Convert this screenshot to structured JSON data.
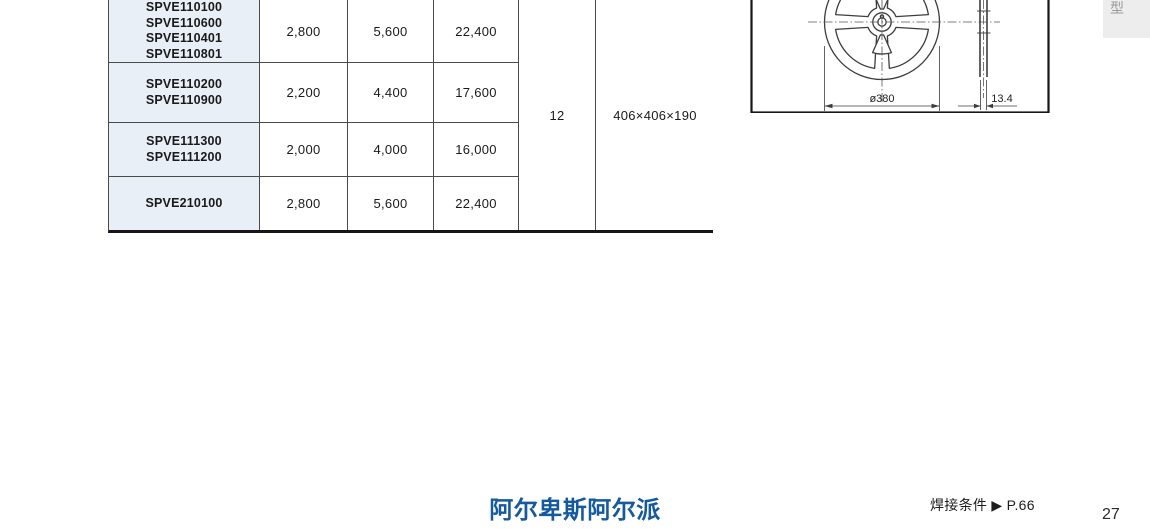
{
  "table": {
    "rows": [
      {
        "part_numbers": "SPVE110100\nSPVE110600\nSPVE110401\nSPVE110801",
        "values": [
          "2,800",
          "5,600",
          "22,400"
        ]
      },
      {
        "part_numbers": "SPVE110200\nSPVE110900",
        "values": [
          "2,200",
          "4,400",
          "17,600"
        ]
      },
      {
        "part_numbers": "SPVE111300\nSPVE111200",
        "values": [
          "2,000",
          "4,000",
          "16,000"
        ]
      },
      {
        "part_numbers": "SPVE210100",
        "values": [
          "2,800",
          "5,600",
          "22,400"
        ]
      }
    ],
    "spanned": {
      "inner_carton_qty": "12",
      "carton_size": "406×406×190"
    }
  },
  "drawing": {
    "reel_diameter_label": "ø380",
    "reel_width_label": "13.4"
  },
  "page": {
    "side_tab_label": "型",
    "footer_logo": "阿尔卑斯阿尔派",
    "solder_reference": "焊接条件 ▶ P.66",
    "page_number": "27"
  },
  "colors": {
    "part_cell_background": "#e9eff6",
    "logo_blue": "#15599e",
    "table_border": "#4a4a4a"
  }
}
